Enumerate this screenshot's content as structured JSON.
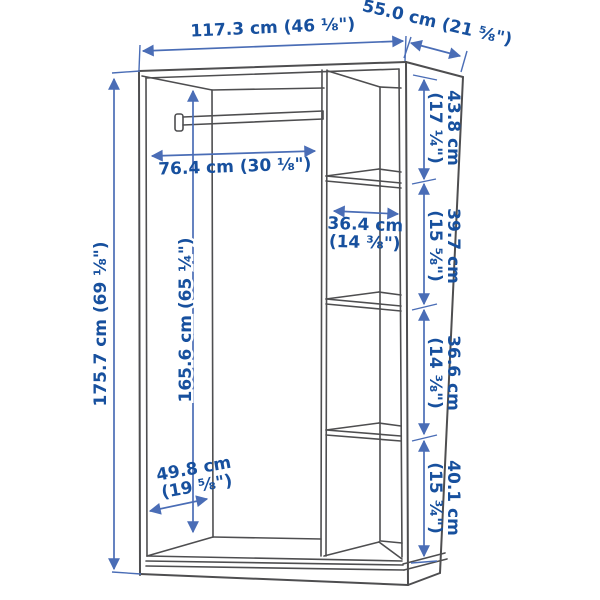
{
  "diagram": {
    "type": "furniture-dimension-diagram",
    "subject": "open wardrobe frame with clothes rail and four shelf sections",
    "labels": {
      "overall_width": "117.3 cm (46 ⅛\")",
      "overall_depth": "55.0 cm (21 ⅝\")",
      "overall_height": "175.7 cm (69 ⅛\")",
      "interior_height": "165.6 cm (65 ¼\")",
      "rail_width": "76.4 cm (30 ⅛\")",
      "shelf_width": [
        "36.4 cm",
        "(14 ⅜\")"
      ],
      "section_top": [
        "43.8 cm",
        "(17 ¼\")"
      ],
      "section_second": [
        "39.7 cm",
        "(15 ⅝\")"
      ],
      "section_third": [
        "36.6 cm",
        "(14 ⅜\")"
      ],
      "section_bottom": [
        "40.1 cm",
        "(15 ¾\")"
      ],
      "interior_depth": [
        "49.8 cm",
        "(19 ⅝\")"
      ]
    },
    "colors": {
      "background": "#ffffff",
      "cabinet_line": "#4e4e50",
      "dimension_line": "#4a6db6",
      "label_text": "#17509e"
    }
  }
}
